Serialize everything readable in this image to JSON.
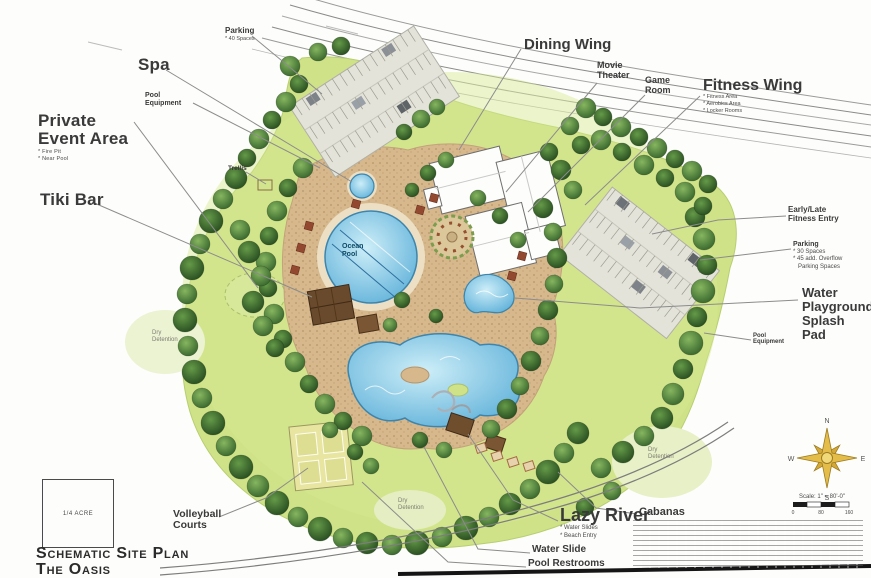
{
  "document": {
    "title_line1": "Schematic Site Plan",
    "title_line2": "The Oasis"
  },
  "area_box_label": "1/4 ACRE",
  "compass": {
    "n": "N",
    "e": "E",
    "s": "S",
    "w": "W"
  },
  "scale": {
    "label": "Scale: 1\" = 80'-0\"",
    "ticks": [
      "0",
      "80",
      "160"
    ]
  },
  "plan_text": {
    "ocean_pool": "Ocean\nPool",
    "dry_detention": "Dry\nDetention"
  },
  "callouts": {
    "parking_nw": {
      "label": "Parking",
      "note1": "* 40 Spaces"
    },
    "spa": {
      "label": "Spa"
    },
    "pool_equipment_nw": {
      "label": "Pool\nEquipment"
    },
    "private_event_area": {
      "label": "Private\nEvent Area",
      "note1": "* Fire Pit",
      "note2": "* Near Pool"
    },
    "tiki_bar": {
      "label": "Tiki Bar"
    },
    "trellis": {
      "label": "Trellis"
    },
    "dining_wing": {
      "label": "Dining Wing"
    },
    "movie_theater": {
      "label": "Movie\nTheater"
    },
    "game_room": {
      "label": "Game\nRoom"
    },
    "fitness_wing": {
      "label": "Fitness Wing",
      "note1": "* Fitness Area",
      "note2": "* Aerobics Area",
      "note3": "* Locker Rooms"
    },
    "fitness_entry": {
      "label": "Early/Late\nFitness Entry"
    },
    "parking_e": {
      "label": "Parking",
      "note1": "* 30 Spaces",
      "note2": "* 45 add. Overflow",
      "note3": "Parking Spaces"
    },
    "water_playground": {
      "label": "Water\nPlayground/\nSplash\nPad"
    },
    "pool_equipment_e": {
      "label": "Pool\nEquipment"
    },
    "cabanas": {
      "label": "Cabanas"
    },
    "lazy_river": {
      "label": "Lazy River",
      "note1": "* Water Slides",
      "note2": "* Beach Entry"
    },
    "water_slide": {
      "label": "Water Slide"
    },
    "pool_restrooms": {
      "label": "Pool Restrooms"
    },
    "volleyball": {
      "label": "Volleyball\nCourts"
    }
  }
}
